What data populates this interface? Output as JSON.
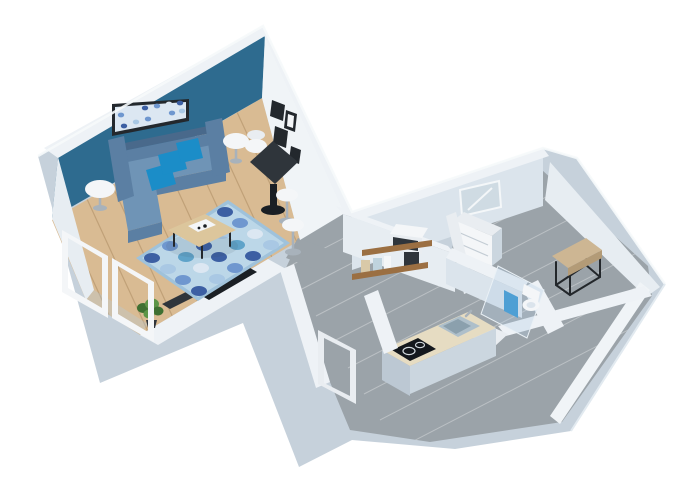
{
  "meta": {
    "title": "3D isometric apartment floor plan rendering",
    "background": "#ffffff"
  },
  "palette": {
    "wall": "#c6d1db",
    "wallTop": "#eef2f6",
    "wallFaceLit": "#e7edf2",
    "wallFaceMed": "#dbe4ec",
    "wallFaceBright": "#f0f4f7",
    "wallSideDark": "#bcc8d3",
    "wallSideMed": "#cbd6df",
    "accent": "#2e6b8f",
    "wood": "#d9bb93",
    "woodLine": "rgba(130,92,52,0.28)",
    "gray": "#9ba3a9",
    "grayLine": "rgba(255,255,255,0.32)",
    "sofa": "#5b7fa3",
    "sofaDark": "#49698b",
    "sofaLight": "#6f94b6",
    "cushion": "#1b8dc8",
    "rugBase": "#bcd7e8",
    "rugBorder": "#9fc2db",
    "rugNavy": "#3c5fa3",
    "rugMid": "#6f97cf",
    "rugPale": "#dce7f2",
    "rugLight": "#a9c8e4",
    "rugTeal": "#5fa3c9",
    "tableWood": "#dcc69c",
    "dark": "#2f353b",
    "black": "#1a1f24",
    "white": "#f4f6f8",
    "offWhite": "#e9edf1",
    "chrome": "#a8b2bb",
    "counter": "#e6dcc2",
    "cooktop": "#14181d",
    "steel": "#aebfca",
    "steelDark": "#8ba0ad",
    "bench": "#cdb693",
    "benchSide": "#b39b77",
    "towel": "#4e9fd4",
    "glassFill": "rgba(180,205,228,0.32)",
    "glassEdge": "#eaf1f6",
    "plant": "#5d9547",
    "plantDark": "#3f7032",
    "mirrorGlass": "#cfdbe3",
    "frameDark": "#23282d",
    "shelf": "#9b6f42",
    "jarBeige": "#d9c9a8",
    "jarBlue": "#bfd3de",
    "tvBlack": "#1a1f24"
  },
  "scene": {
    "type": "3d-isometric-floor-plan",
    "rooms": [
      "living-room",
      "hallway",
      "entry",
      "kitchen",
      "bathroom",
      "dressing-room"
    ],
    "furniture": [
      "blue-sofa",
      "bright-blue-cushions",
      "wall-art",
      "picture-frames",
      "round-side-tables",
      "patterned-rug",
      "coffee-table",
      "black-dining-table",
      "white-chair",
      "bar-stools",
      "tv-niche",
      "media-console",
      "green-plant",
      "glass-door-frames",
      "wall-shelves",
      "microwave",
      "jars",
      "kitchen-counter",
      "cooktop",
      "sink",
      "shower-glass",
      "toilet",
      "blue-towel",
      "shower-tray",
      "leaning-mirror",
      "white-dresser",
      "bench"
    ]
  },
  "decor": {
    "rug_circles": [
      [
        152,
        258,
        "rugNavy"
      ],
      [
        170,
        246,
        "rugMid"
      ],
      [
        188,
        235,
        "rugPale"
      ],
      [
        207,
        223,
        "rugMid"
      ],
      [
        225,
        212,
        "rugNavy"
      ],
      [
        168,
        269,
        "rugLight"
      ],
      [
        186,
        257,
        "rugTeal"
      ],
      [
        204,
        246,
        "rugNavy"
      ],
      [
        222,
        234,
        "rugLight"
      ],
      [
        240,
        223,
        "rugMid"
      ],
      [
        183,
        280,
        "rugMid"
      ],
      [
        201,
        268,
        "rugPale"
      ],
      [
        219,
        257,
        "rugNavy"
      ],
      [
        237,
        245,
        "rugTeal"
      ],
      [
        255,
        234,
        "rugPale"
      ],
      [
        199,
        291,
        "rugNavy"
      ],
      [
        217,
        279,
        "rugLight"
      ],
      [
        235,
        268,
        "rugMid"
      ],
      [
        253,
        256,
        "rugNavy"
      ],
      [
        271,
        245,
        "rugLight"
      ]
    ],
    "art_circles": [
      [
        121,
        115,
        "rugMid"
      ],
      [
        133,
        111,
        "rugPale"
      ],
      [
        145,
        108,
        "rugNavy"
      ],
      [
        157,
        106,
        "rugMid"
      ],
      [
        169,
        104,
        "rugPale"
      ],
      [
        180,
        103,
        "rugNavy"
      ],
      [
        124,
        126,
        "rugNavy"
      ],
      [
        136,
        122,
        "rugLight"
      ],
      [
        148,
        119,
        "rugMid"
      ],
      [
        160,
        116,
        "rugPale"
      ],
      [
        172,
        113,
        "rugMid"
      ],
      [
        182,
        111,
        "rugLight"
      ]
    ],
    "wood_lines": [
      [
        237,
        112,
        346,
        349
      ],
      [
        212,
        127,
        321,
        364
      ],
      [
        187,
        141,
        296,
        378
      ],
      [
        162,
        156,
        271,
        393
      ],
      [
        137,
        170,
        246,
        407
      ],
      [
        112,
        185,
        221,
        422
      ],
      [
        87,
        199,
        196,
        436
      ],
      [
        62,
        213,
        171,
        450
      ]
    ],
    "gray_lines": [
      [
        270,
        250,
        618,
        70
      ],
      [
        286,
        268,
        634,
        88
      ],
      [
        300,
        290,
        648,
        110
      ],
      [
        316,
        316,
        664,
        136
      ],
      [
        332,
        342,
        680,
        162
      ],
      [
        348,
        368,
        696,
        188
      ],
      [
        364,
        394,
        712,
        214
      ],
      [
        380,
        420,
        728,
        240
      ],
      [
        400,
        448,
        748,
        268
      ]
    ]
  }
}
